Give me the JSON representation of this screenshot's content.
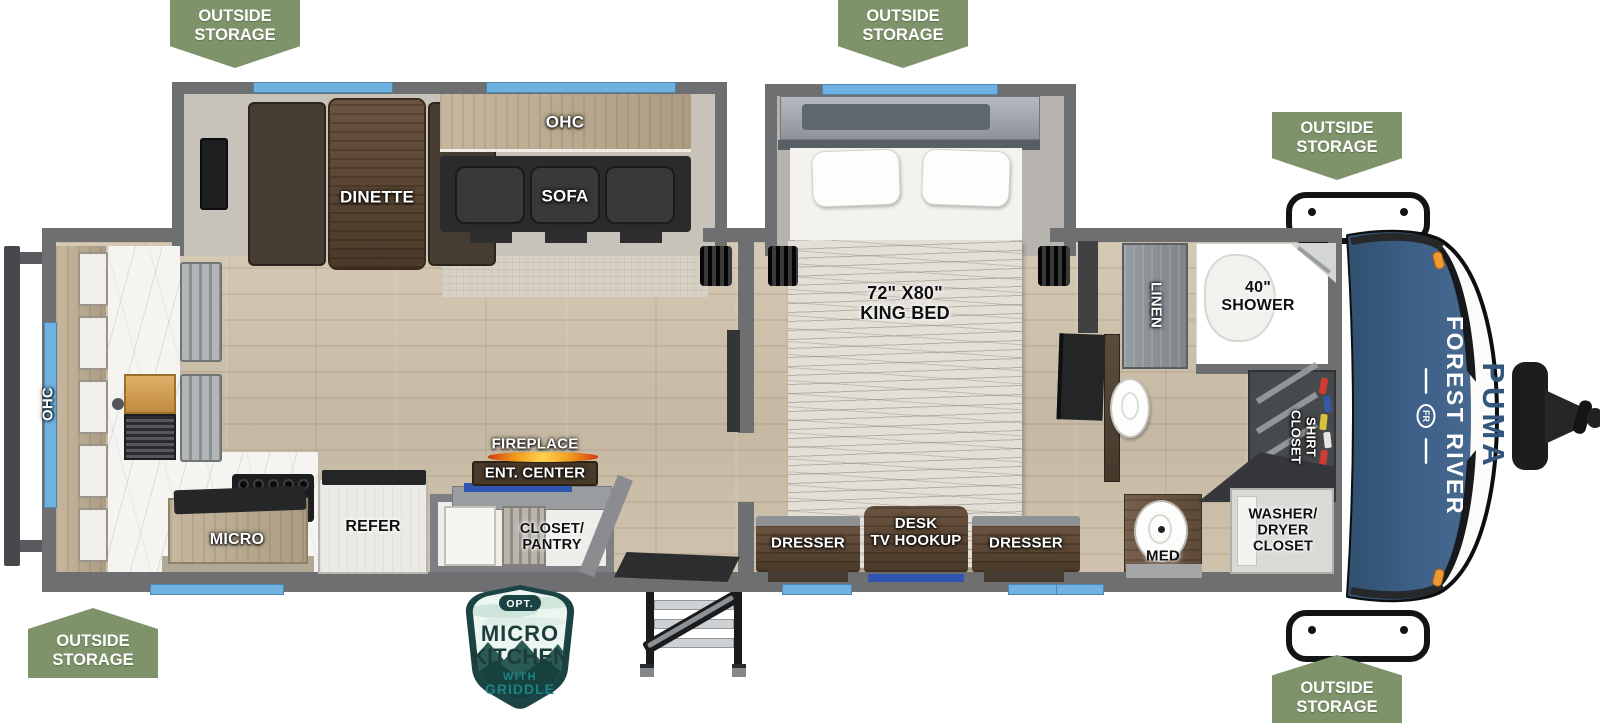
{
  "banner": {
    "text": "OUTSIDE\nSTORAGE"
  },
  "brand": {
    "crest": "FR",
    "maker": "FOREST RIVER",
    "model": "PUMA"
  },
  "badge": {
    "opt": "OPT.",
    "title1": "MICRO",
    "title2": "KITCHEN",
    "sub1": "WITH",
    "sub2": "GRIDDLE"
  },
  "labels": {
    "dinette": "DINETTE",
    "ohc_slide": "OHC",
    "sofa": "SOFA",
    "king_bed": "72\" X80\"\nKING BED",
    "ohc_rear": "OHC",
    "fireplace": "FIREPLACE",
    "ent_center": "ENT. CENTER",
    "closet_pantry": "CLOSET/\nPANTRY",
    "refer": "REFER",
    "micro": "MICRO",
    "dresser_left": "DRESSER",
    "desk_tv": "DESK\nTV HOOKUP",
    "dresser_right": "DRESSER",
    "linen": "LINEN",
    "shower": "40\"\nSHOWER",
    "shirt_closet": "SHIRT\nCLOSET",
    "med": "MED",
    "washer_dryer": "WASHER/\nDRYER\nCLOSET"
  },
  "colors": {
    "banner_green": "#7e9369",
    "window_blue": "#6fb1e0",
    "wall_gray": "#6d6f71",
    "cap_blue": "#3a5c80",
    "badge_dark_teal": "#1c4343",
    "badge_teal": "#1b8383",
    "flame_orange": "#f09b1d",
    "tv_blue": "#2e55b0"
  }
}
